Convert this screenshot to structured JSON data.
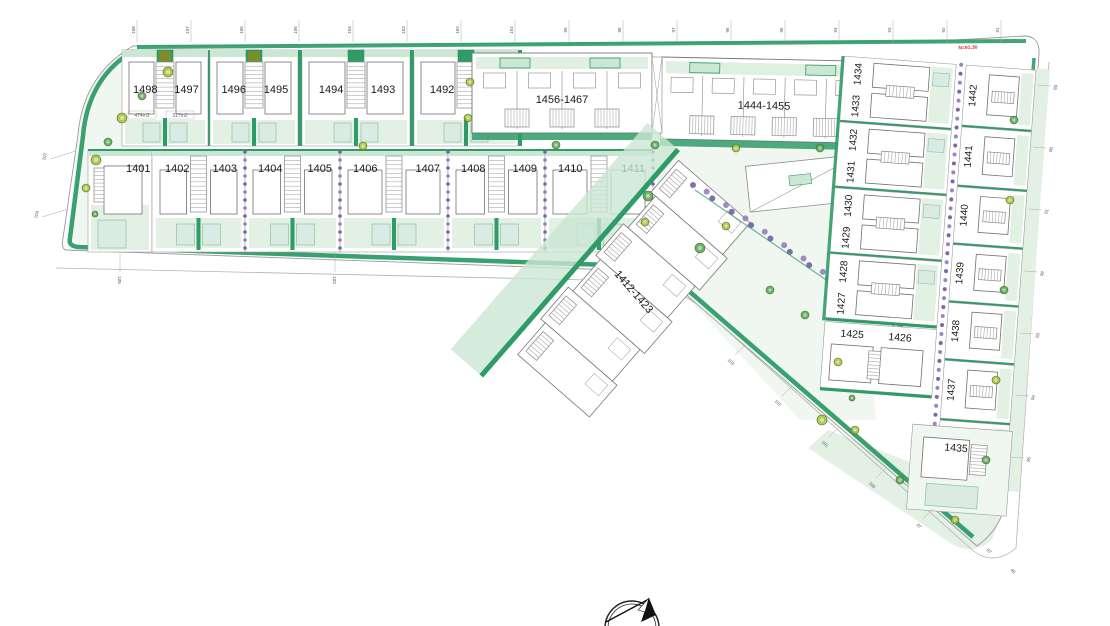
{
  "plan": {
    "row1_pairs": [
      {
        "left": "1498",
        "right": "1497",
        "area_left": "474m2",
        "area_right": "317m2"
      },
      {
        "left": "1496",
        "right": "1495"
      },
      {
        "left": "1494",
        "right": "1493"
      },
      {
        "left": "1492",
        "right": "1491"
      }
    ],
    "row1_blocks": [
      {
        "label": "1456-1467"
      },
      {
        "label": "1444-1455"
      }
    ],
    "row2_cells": [
      {
        "labels": [
          "1401"
        ]
      },
      {
        "labels": [
          "1402",
          "1403"
        ]
      },
      {
        "labels": [
          "1404",
          "1405"
        ]
      },
      {
        "labels": [
          "1406",
          "1407"
        ]
      },
      {
        "labels": [
          "1408",
          "1409"
        ]
      },
      {
        "labels": [
          "1410",
          "1411"
        ]
      }
    ],
    "diagonal_block": {
      "label": "1412-1423"
    },
    "wing_inner_pairs": [
      {
        "top": "1434",
        "bottom": "1433"
      },
      {
        "top": "1432",
        "bottom": "1431"
      },
      {
        "top": "1430",
        "bottom": "1429"
      },
      {
        "top": "1428",
        "bottom": "1427"
      }
    ],
    "wing_bottom_pair": {
      "left": "1425",
      "right": "1426"
    },
    "wing_outer": [
      "1442",
      "1441",
      "1440",
      "1439",
      "1438",
      "1437",
      "1436"
    ],
    "wing_corner_plot": "1435",
    "level_annotation": "N=91.30",
    "ticks": {
      "top": [
        "108",
        "107",
        "106",
        "105",
        "104",
        "103",
        "102",
        "101",
        "99",
        "98",
        "97",
        "96",
        "95",
        "94",
        "93",
        "92",
        "91"
      ],
      "left": [
        "107",
        "104"
      ],
      "bottom_left": [
        "105",
        "103"
      ],
      "diagonal": [
        "103",
        "102",
        "101",
        "100",
        "97"
      ],
      "right": [
        "89",
        "90",
        "91",
        "92",
        "93",
        "94",
        "95"
      ],
      "corner": [
        "97",
        "46"
      ]
    }
  },
  "colors": {
    "hedge": "#2E9B68",
    "hedge_dark": "#1F8A57",
    "band": "#CBE6D2",
    "lawn": "#E2F1E4",
    "lawn_light": "#EFF7F0",
    "pool": "#D9EBE3",
    "pool_edge": "#8FBFA7",
    "purple": "#8F77BE",
    "purple_dark": "#6C56A0",
    "olive": "#A9BD3C",
    "tree_green": "#55A357",
    "outline": "#9B9B9B",
    "building": "#707070",
    "dim": "#8A8A8A",
    "red": "#C03A30",
    "ink": "#1A1A1A"
  }
}
